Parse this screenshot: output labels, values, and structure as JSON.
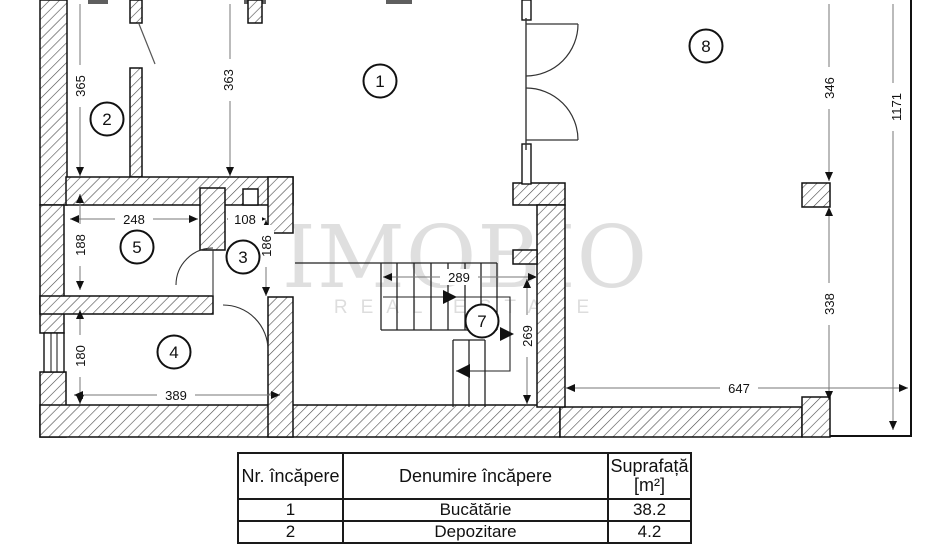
{
  "watermark": {
    "brand": "IMOBIO",
    "tagline": "REAL ESTATE"
  },
  "plan": {
    "rooms": {
      "r1": "1",
      "r2": "2",
      "r3": "3",
      "r4": "4",
      "r5": "5",
      "r7": "7",
      "r8": "8"
    },
    "dims": {
      "d365": "365",
      "d363": "363",
      "d248": "248",
      "d108": "108",
      "d188": "188",
      "d186": "186",
      "d180": "180",
      "d389": "389",
      "d289": "289",
      "d269": "269",
      "d346": "346",
      "d338": "338",
      "d647": "647",
      "d1171": "1171"
    }
  },
  "table": {
    "headers": {
      "nr": "Nr. încăpere",
      "name": "Denumire încăpere",
      "area_line1": "Suprafață",
      "area_line2": "[m²]"
    },
    "rows": [
      {
        "nr": "1",
        "name": "Bucătărie",
        "area": "38.2"
      },
      {
        "nr": "2",
        "name": "Depozitare",
        "area": "4.2"
      }
    ]
  }
}
